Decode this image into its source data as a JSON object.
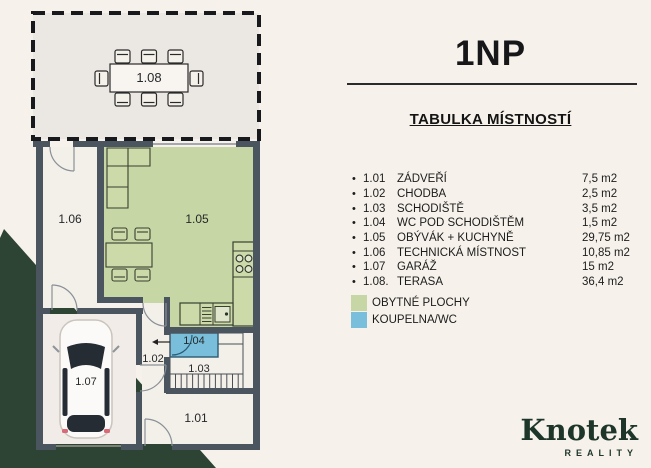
{
  "header": {
    "title": "1NP",
    "table_heading": "TABULKA MÍSTNOSTÍ"
  },
  "rooms": [
    {
      "number": "1.01",
      "name": "ZÁDVEŘÍ",
      "area": "7,5 m2"
    },
    {
      "number": "1.02",
      "name": "CHODBA",
      "area": "2,5 m2"
    },
    {
      "number": "1.03",
      "name": "SCHODIŠTĚ",
      "area": "3,5 m2"
    },
    {
      "number": "1.04",
      "name": "WC POD SCHODIŠTĚM",
      "area": "1,5 m2"
    },
    {
      "number": "1.05",
      "name": "OBÝVÁK + KUCHYNĚ",
      "area": "29,75 m2"
    },
    {
      "number": "1.06",
      "name": "TECHNICKÁ MÍSTNOST",
      "area": "10,85 m2"
    },
    {
      "number": "1.07",
      "name": "GARÁŽ",
      "area": "15 m2"
    },
    {
      "number": "1.08.",
      "name": "TERASA",
      "area": "36,4 m2"
    }
  ],
  "legend": [
    {
      "label": "OBYTNÉ PLOCHY",
      "color": "#c6d6a4"
    },
    {
      "label": "KOUPELNA/WC",
      "color": "#79bedb"
    }
  ],
  "floorplan": {
    "labels": {
      "terrace": "1.08",
      "technical": "1.06",
      "living": "1.05",
      "garage": "1.07",
      "hallway": "1.02",
      "wc": "1.04",
      "stairs": "1.03",
      "entry": "1.01"
    }
  },
  "logo": {
    "name": "Knotek",
    "subtitle": "REALITY"
  },
  "colors": {
    "living_green": "#c6d6a4",
    "wc_blue": "#79bedb",
    "walls": "#4b5560",
    "brand_green": "#1d3629",
    "corner_green": "#2d4334",
    "background": "#f6f2eb"
  }
}
